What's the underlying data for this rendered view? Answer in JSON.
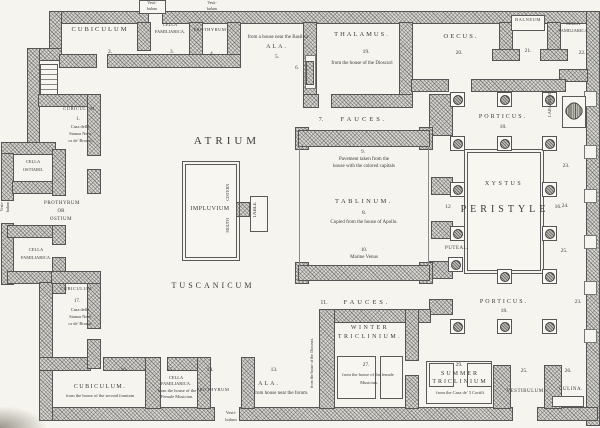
{
  "labels": {
    "cubiculum2": "CUBICULUM",
    "no2": "2.",
    "c3a": "CELLA",
    "c3b": "FAMILIARICA.",
    "no3": "3.",
    "prothyrum4": "PROTHYRUM",
    "no4": "4.",
    "vesti1": "Vesti-",
    "vesti2": "bulum",
    "ala5_note": "from a house near the Basilica",
    "ala5": "ALA.",
    "no5": "5.",
    "no6": "6.",
    "thalamus": "THALAMUS.",
    "no19": "19.",
    "thal_note": "from the house of the Dioscuri",
    "oecus": "OECUS.",
    "no20": "20.",
    "balneum": "BALNEUM",
    "no21": "21.",
    "c22a": "CELLA",
    "c22b": "FAMILIARICA",
    "no22": "22.",
    "no7": "7.",
    "fauces": "FAUCES.",
    "porticus": "PORTICUS.",
    "no18": "18.",
    "lararium": "LARARIUM.",
    "n23": "23.",
    "n24": "24.",
    "n25": "25.",
    "n23c": "23.",
    "atrium": "ATRIUM",
    "tuscanicum": "TUSCANICUM",
    "impluvium": "IMPLUVIUM",
    "cistern": "CISTERN",
    "mouth": "MOUTH",
    "table": "TABLE",
    "no9": "9.",
    "tabn1": "Pavement taken from the",
    "tabn2": "house with the colored capitals",
    "tablinum": "TABLINUM.",
    "no8": "8.",
    "tabn3": "Copied from the house of Apollo.",
    "no10": "10.",
    "tabn4": "Marine Venus",
    "peristyle": "PERISTYLE",
    "no12": "12",
    "no16": "16.",
    "xystus": "XYSTUS",
    "puteal": "PUTEAL.",
    "no11": "11.",
    "winter1": "WINTER",
    "winter2": "TRICLINIUM.",
    "no27": "27.",
    "wnote1": "from the house of the female",
    "wnote2": "Musician.",
    "dioscuri": "from the house of the Dioscuri.",
    "no29": "29.",
    "summer1": "SUMMER",
    "summer2": "TRICLINIUM",
    "snote": "from the Casa de' 3 Cortili",
    "vestibulum": "VESTIBULUM.",
    "no25b": "25.",
    "no26": "26.",
    "culina": "CULINA.",
    "cub1": "CUBICULUM",
    "no1": "1.",
    "casa1": "Casa della",
    "casa2": "Stanza Nera",
    "casa3": "or de' Bronzi",
    "cellaost1": "CELLA",
    "cellaost2": "OSTIARII.",
    "ostium1": "PROTHYRUM",
    "ostium2": "OR",
    "ostium3": "OSTIUM",
    "cfL1": "CELLA",
    "cfL2": "FAMILIARICA.",
    "cub17": "CUBICULUM",
    "no17": "17.",
    "cub16": "CUBICULUM.",
    "cub16n": "from the house of the second fountain",
    "no16b": "16.",
    "c15a": "CELLA",
    "c15b": "FAMILIARICA.",
    "c15c": "from the house of the",
    "c15d": "Female Musician.",
    "no15": "15.",
    "prothyrum14": "PROTHYRUM",
    "no14": "14.",
    "no13": "13.",
    "ala13": "ALA.",
    "ala13n": "from house near the forum."
  }
}
